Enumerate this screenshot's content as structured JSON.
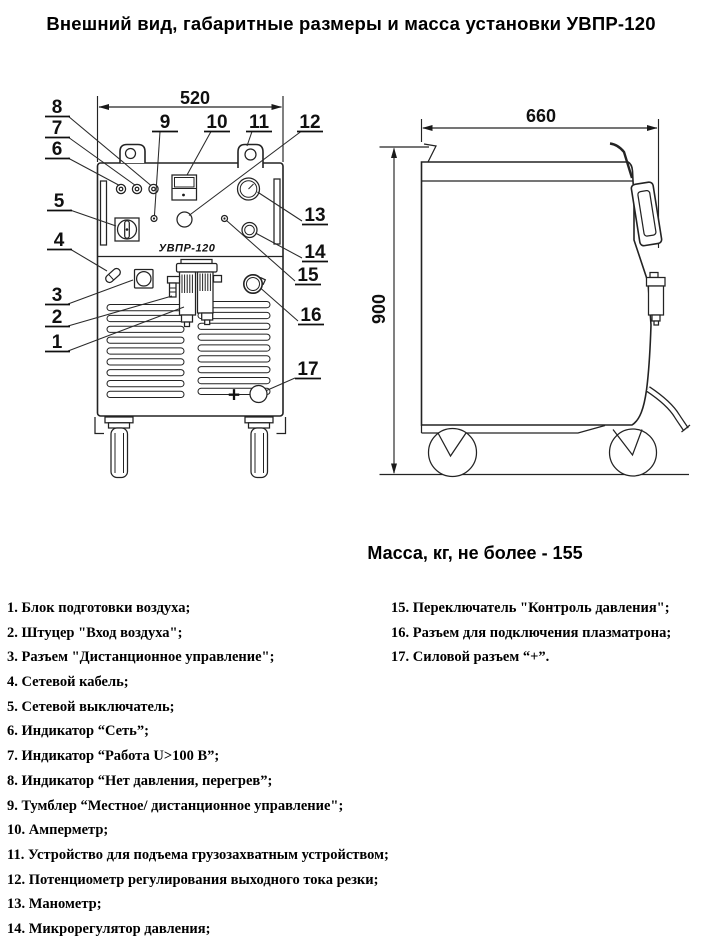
{
  "title": "Внешний вид, габаритные размеры и масса установки УВПР-120",
  "drawing": {
    "dim_width": "520",
    "dim_depth": "660",
    "dim_height": "900",
    "model_label": "УВПР-120",
    "plus_symbol": "+",
    "callouts": [
      "1",
      "2",
      "3",
      "4",
      "5",
      "6",
      "7",
      "8",
      "9",
      "10",
      "11",
      "12",
      "13",
      "14",
      "15",
      "16",
      "17"
    ]
  },
  "mass_note": "Масса, кг, не более - 155",
  "legend": {
    "left": [
      "1. Блок подготовки воздуха;",
      "2. Штуцер \"Вход воздуха\";",
      "3. Разъем \"Дистанционное управление\";",
      "4. Сетевой кабель;",
      "5. Сетевой выключатель;",
      "6. Индикатор “Сеть”;",
      "7. Индикатор “Работа U>100 В”;",
      "8. Индикатор “Нет давления, перегрев”;",
      "9. Тумблер “Местное/ дистанционное управление\";",
      "10. Амперметр;",
      "11. Устройство для подъема грузозахватным устройством;",
      "12. Потенциометр регулирования выходного тока резки;",
      "13. Манометр;",
      "14. Микрорегулятор давления;"
    ],
    "right": [
      "15. Переключатель \"Контроль давления\";",
      "16. Разъем для подключения плазматрона;",
      "17. Силовой разъем “+”."
    ]
  },
  "colors": {
    "line": "#232323",
    "text": "#000000",
    "background": "#ffffff"
  }
}
